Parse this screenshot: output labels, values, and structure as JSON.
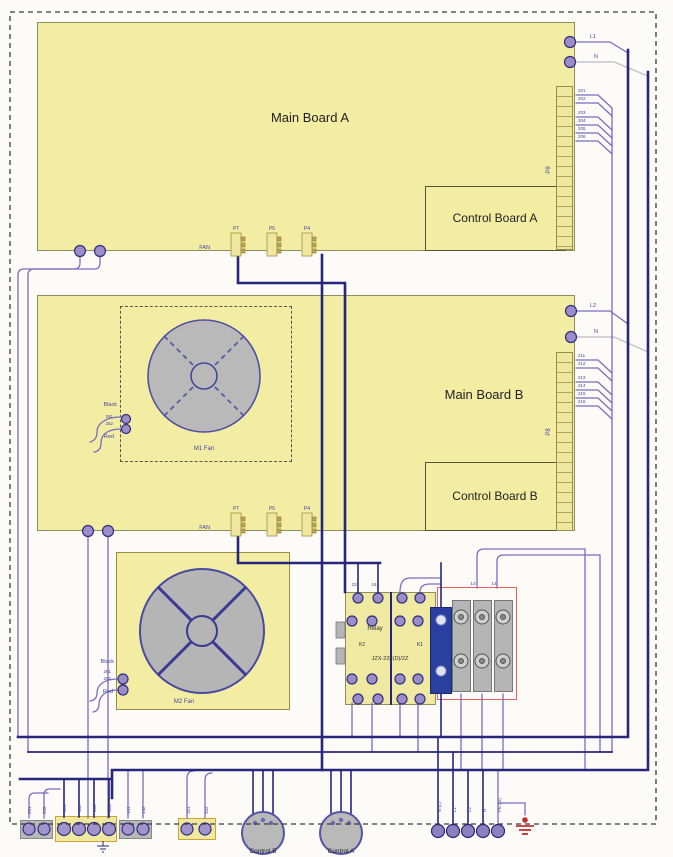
{
  "boards": {
    "main_a": {
      "label": "Main Board A"
    },
    "control_a": {
      "label": "Control Board A"
    },
    "main_b": {
      "label": "Main Board B"
    },
    "control_b": {
      "label": "Control Board B"
    }
  },
  "fans": {
    "m1": {
      "label": "M1 Fan",
      "black": "Black",
      "red": "Red",
      "pin1": "251",
      "pin2": "252"
    },
    "m2": {
      "label": "M2 Fan",
      "black": "Black",
      "red": "Red",
      "pin1": "261",
      "pin2": "262"
    }
  },
  "relay": {
    "label": "Relay",
    "k2": "K2",
    "k1": "K1",
    "part": "JZX-22F(D)/2Z",
    "top_pins": [
      "23",
      "24",
      "13",
      "14"
    ]
  },
  "connectors": {
    "fan": "FAN",
    "p7": "P7",
    "p5": "P5",
    "p4": "P4",
    "p8": "P8"
  },
  "wire_labels": {
    "a_l1": "L1",
    "a_n": "N",
    "b_l2": "L2",
    "b_n": "N",
    "a_pins": [
      "201",
      "202",
      "203",
      "204",
      "205",
      "206"
    ],
    "b_pins": [
      "211",
      "212",
      "213",
      "214",
      "215",
      "216"
    ]
  },
  "bottom": {
    "knob_b": "Control B",
    "knob_a": "Control A",
    "left_labels": [
      "231",
      "232",
      "101",
      "102",
      "103",
      "104",
      "141",
      "142",
      "151",
      "152"
    ],
    "power_labels": [
      "N (L)",
      "L1",
      "L2",
      "N",
      "PE (G)"
    ]
  },
  "colors": {
    "board_yellow": "#f2eda2",
    "wire_navy": "#26267d",
    "wire_purple": "#7a6cc0",
    "fan_gray": "#b9b9b9",
    "terminal_purple": "#9b8dc8",
    "outline_red": "#e06060",
    "relay_block_blue": "#2a3f9e",
    "ground_red": "#c03030"
  }
}
